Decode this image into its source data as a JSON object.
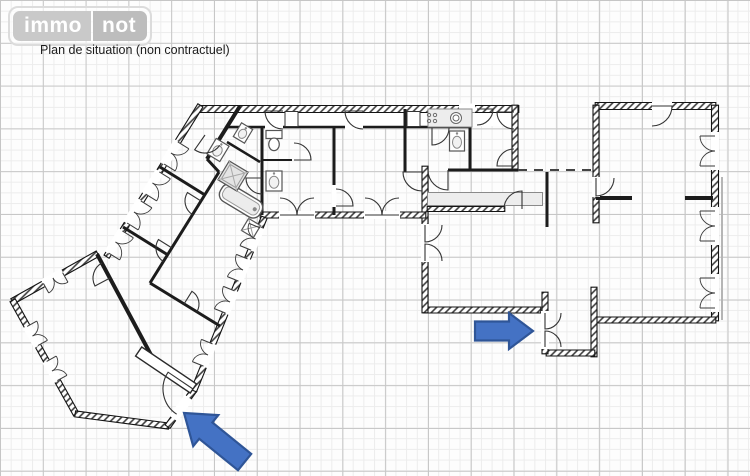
{
  "header": {
    "logo_immo": "immo",
    "logo_not": "not",
    "caption": "Plan de situation (non contractuel)"
  },
  "colors": {
    "wall": "#1c1c1c",
    "wall_hatch": "#3c3c3c",
    "door": "#333333",
    "window": "#3a3a3a",
    "fixture_stroke": "#555555",
    "fixture_fill": "#ffffff",
    "counter_fill": "#ededed",
    "gray_line": "#b5b5b5",
    "arrow_fill": "#4472c4",
    "arrow_stroke": "#2f5597",
    "grid_minor": "#ececec",
    "grid_major": "#c6c6c6"
  },
  "floorplan": {
    "underlays": [
      {
        "t": "whiterect",
        "x": 371.5,
        "y": 119,
        "w": 287,
        "h": 14,
        "r": 0
      }
    ],
    "walls": [
      [
        200,
        109,
        518,
        109,
        7,
        "h"
      ],
      [
        515,
        106,
        515,
        170,
        6,
        "h"
      ],
      [
        596,
        106,
        715,
        106,
        7,
        "h"
      ],
      [
        715,
        106,
        715,
        320,
        7,
        "h"
      ],
      [
        715,
        320,
        596,
        320,
        6,
        "h"
      ],
      [
        596,
        106,
        596,
        222,
        6,
        "h"
      ],
      [
        594,
        288,
        594,
        356,
        6,
        "h"
      ],
      [
        594,
        353,
        547,
        353,
        6,
        "h"
      ],
      [
        545,
        353,
        545,
        293,
        6,
        "h"
      ],
      [
        540,
        310,
        424,
        310,
        6,
        "h"
      ],
      [
        425,
        312,
        425,
        167,
        6,
        "h"
      ],
      [
        425,
        215,
        261,
        215,
        6,
        "h"
      ],
      [
        200,
        106,
        107,
        256,
        6,
        "h"
      ],
      [
        97,
        254,
        13,
        301,
        6,
        "h"
      ],
      [
        13,
        301,
        76,
        414,
        6,
        "h"
      ],
      [
        76,
        414,
        168,
        426,
        6,
        "h"
      ],
      [
        168,
        426,
        194,
        390,
        6,
        "h"
      ],
      [
        194,
        390,
        264,
        218,
        6,
        "h"
      ],
      [
        428,
        209,
        504,
        209,
        5,
        "h"
      ],
      [
        240,
        106,
        207,
        159,
        4,
        "s"
      ],
      [
        262,
        127,
        262,
        215,
        3,
        "s"
      ],
      [
        334,
        127,
        334,
        215,
        3,
        "s"
      ],
      [
        405,
        109,
        405,
        172,
        3,
        "s"
      ],
      [
        470,
        109,
        470,
        170,
        3,
        "s"
      ],
      [
        228,
        127,
        470,
        127,
        2.5,
        "s"
      ],
      [
        262,
        160,
        292,
        160,
        2,
        "s"
      ],
      [
        547,
        172,
        547,
        227,
        3,
        "s"
      ],
      [
        596,
        198,
        632,
        198,
        4,
        "s"
      ],
      [
        685,
        198,
        713,
        198,
        4,
        "s"
      ],
      [
        448,
        170,
        518,
        170,
        3,
        "s"
      ],
      [
        219,
        172,
        150,
        283,
        3,
        "s"
      ],
      [
        160,
        167,
        205,
        195,
        3,
        "s"
      ],
      [
        123,
        227,
        168,
        255,
        3,
        "s"
      ],
      [
        150,
        283,
        220,
        326,
        3,
        "s"
      ],
      [
        97,
        254,
        158,
        368,
        4,
        "s"
      ],
      [
        207,
        159,
        219,
        172,
        3,
        "s"
      ],
      [
        227,
        142,
        260,
        162,
        2.5,
        "s"
      ],
      [
        518,
        170,
        592,
        170,
        2,
        "d"
      ]
    ],
    "gaps": [
      [
        467,
        108,
        16,
        9,
        0
      ],
      [
        274,
        127,
        18,
        5,
        0
      ],
      [
        354,
        127,
        18,
        5,
        0
      ],
      [
        297,
        215,
        36,
        8,
        0
      ],
      [
        382,
        215,
        36,
        8,
        0
      ],
      [
        425,
        243,
        8,
        38,
        0
      ],
      [
        545,
        330,
        8,
        38,
        0
      ],
      [
        596,
        187,
        8,
        20,
        0
      ],
      [
        662,
        106,
        20,
        8,
        0
      ],
      [
        715,
        151,
        8,
        38,
        0
      ],
      [
        715,
        226,
        8,
        38,
        0
      ],
      [
        715,
        293,
        8,
        38,
        0
      ],
      [
        171,
        153,
        27,
        9,
        121.8
      ],
      [
        152.5,
        183,
        27,
        9,
        121.8
      ],
      [
        134,
        212,
        27,
        9,
        121.8
      ],
      [
        115.5,
        242,
        27,
        9,
        121.8
      ],
      [
        208,
        355,
        25,
        9,
        -67.9
      ],
      [
        230,
        302,
        25,
        9,
        -67.9
      ],
      [
        243,
        270,
        25,
        9,
        -67.9
      ],
      [
        255.6,
        239,
        25,
        9,
        -67.9
      ],
      [
        32.5,
        336,
        23,
        9,
        60.9
      ],
      [
        52,
        371,
        23,
        9,
        60.9
      ],
      [
        53,
        278,
        23,
        9,
        150.8
      ],
      [
        181,
        408,
        26,
        10,
        -54.2
      ],
      [
        334,
        196,
        5,
        22,
        0
      ]
    ],
    "doors": [
      [
        283,
        111,
        18,
        90,
        180
      ],
      [
        363,
        111,
        18,
        90,
        180
      ],
      [
        477,
        109,
        16,
        90,
        0
      ],
      [
        514,
        112,
        17,
        90,
        180
      ],
      [
        514,
        166,
        17,
        -90,
        180
      ],
      [
        432,
        128,
        17,
        0,
        90
      ],
      [
        422,
        172,
        19,
        90,
        180
      ],
      [
        448,
        170,
        20,
        180,
        90
      ],
      [
        336,
        206,
        17,
        -90,
        0
      ],
      [
        294,
        160,
        17,
        -90,
        0
      ],
      [
        262,
        178,
        16,
        90,
        180
      ],
      [
        652,
        106,
        20,
        90,
        0
      ],
      [
        596,
        178,
        18,
        0,
        90
      ],
      [
        522,
        209,
        18,
        180,
        270
      ],
      [
        425,
        225,
        17,
        0,
        90
      ],
      [
        425,
        261,
        17,
        0,
        -90
      ],
      [
        545,
        313,
        16,
        0,
        90
      ],
      [
        545,
        347,
        16,
        0,
        -90
      ],
      [
        280,
        215,
        17,
        -90,
        0
      ],
      [
        314,
        215,
        17,
        -90,
        180
      ],
      [
        365,
        215,
        17,
        -90,
        0
      ],
      [
        399,
        215,
        17,
        -90,
        180
      ],
      [
        201,
        201,
        16,
        122,
        212
      ],
      [
        172,
        248,
        16,
        122,
        212
      ],
      [
        205,
        135,
        18,
        35,
        125
      ],
      [
        110,
        278,
        17,
        242,
        152
      ],
      [
        184,
        304,
        15,
        32,
        -58
      ],
      [
        193,
        389,
        30,
        123,
        214
      ]
    ],
    "windows": [
      [
        171,
        153,
        121.8,
        13,
        -1
      ],
      [
        152.5,
        183,
        121.8,
        13,
        -1
      ],
      [
        134,
        212,
        121.8,
        13,
        -1
      ],
      [
        115.5,
        242,
        121.8,
        13,
        -1
      ],
      [
        208,
        355,
        -67.9,
        12,
        -1
      ],
      [
        230,
        302,
        -67.9,
        12,
        -1
      ],
      [
        243,
        270,
        -67.9,
        12,
        -1
      ],
      [
        255.6,
        239,
        -67.9,
        12,
        -1
      ],
      [
        32.5,
        336,
        60.9,
        11,
        -1
      ],
      [
        52,
        371,
        60.9,
        11,
        -1
      ],
      [
        53,
        278,
        150.8,
        11,
        -1
      ],
      [
        715,
        151,
        90,
        15,
        1
      ],
      [
        715,
        226,
        90,
        15,
        1
      ],
      [
        715,
        293,
        90,
        15,
        1
      ]
    ],
    "fixtures": [
      {
        "t": "box",
        "x": 291.5,
        "y": 119,
        "w": 13,
        "h": 15,
        "r": 0
      },
      {
        "t": "box",
        "x": 413.5,
        "y": 119,
        "w": 13,
        "h": 15,
        "r": 0
      },
      {
        "t": "counter",
        "x": 450,
        "y": 118,
        "w": 44,
        "h": 18,
        "r": 0
      },
      {
        "t": "ksink",
        "x": 456,
        "y": 118,
        "w": 11,
        "h": 11,
        "r": 0
      },
      {
        "t": "sink",
        "x": 457,
        "y": 141,
        "w": 15,
        "h": 20,
        "r": 0
      },
      {
        "t": "stove4",
        "x": 432,
        "y": 118,
        "w": 10,
        "h": 10,
        "r": 0
      },
      {
        "t": "counter",
        "x": 485,
        "y": 199,
        "w": 115,
        "h": 13,
        "r": 0
      },
      {
        "t": "bathtub",
        "x": 241,
        "y": 201,
        "w": 46,
        "h": 19,
        "r": 31
      },
      {
        "t": "shower",
        "x": 233,
        "y": 176,
        "w": 22,
        "h": 22,
        "r": 31
      },
      {
        "t": "sink",
        "x": 218,
        "y": 150,
        "w": 15,
        "h": 18,
        "r": 31
      },
      {
        "t": "sink",
        "x": 243,
        "y": 133,
        "w": 13,
        "h": 16,
        "r": 31
      },
      {
        "t": "squarex",
        "x": 251,
        "y": 228,
        "w": 14,
        "h": 14,
        "r": 31
      },
      {
        "t": "wc",
        "x": 274,
        "y": 141,
        "w": 16,
        "h": 21,
        "r": 0
      },
      {
        "t": "sink",
        "x": 274,
        "y": 181,
        "w": 16,
        "h": 20,
        "r": 0
      },
      {
        "t": "doorleaf",
        "x": 166,
        "y": 370,
        "w": 11,
        "h": 66,
        "r": 124
      }
    ],
    "graylines": [
      [
        [
          722,
          177
        ],
        [
          722,
          320
        ]
      ]
    ],
    "arrows": [
      {
        "name": "entrance-arrow-right",
        "tip": [
          533,
          331
        ],
        "deg": 0,
        "len": 58,
        "head_len": 24,
        "shaft_half": 9.5,
        "head_half": 18
      },
      {
        "name": "entrance-arrow-left",
        "tip": [
          184,
          413
        ],
        "deg": 219,
        "len": 78,
        "head_len": 28,
        "shaft_half": 10.5,
        "head_half": 20
      }
    ]
  }
}
